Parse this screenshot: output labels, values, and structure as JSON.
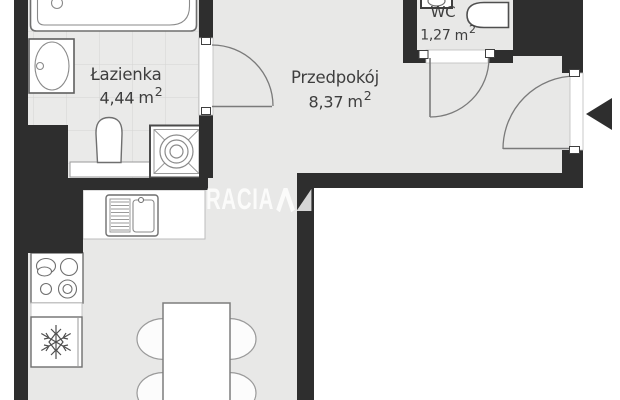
{
  "rooms": {
    "bathroom": {
      "name": "Łazienka",
      "area_value": "4,44",
      "area_unit": "m",
      "area_sup": "2"
    },
    "hallway": {
      "name": "Przedpokój",
      "area_value": "8,37",
      "area_unit": "m",
      "area_sup": "2"
    },
    "wc": {
      "name": "WC",
      "area_value": "1,27",
      "area_unit": "m",
      "area_sup": "2"
    }
  },
  "watermark": {
    "text_left": "RACIA",
    "text_right": "SA",
    "logo": "double-triangle-mark"
  },
  "fixtures": [
    "bathtub",
    "washbasin",
    "toilet",
    "shower-tray",
    "wc-sink",
    "wc-toilet",
    "kitchen-counter",
    "kitchen-sink",
    "stove",
    "fridge-snowflake",
    "dining-table",
    "chairs",
    "entrance-arrow",
    "door-swings"
  ],
  "colors": {
    "wall": "#2e2e2e",
    "floor": "#e8e8e7",
    "tile_floor": "#eaeae9",
    "tile_line": "#d4d4d3",
    "fixture_outline": "#6f6f6f",
    "label_text": "#3e3e3e",
    "background": "#ffffff",
    "watermark": "rgba(255,255,255,0.8)"
  }
}
